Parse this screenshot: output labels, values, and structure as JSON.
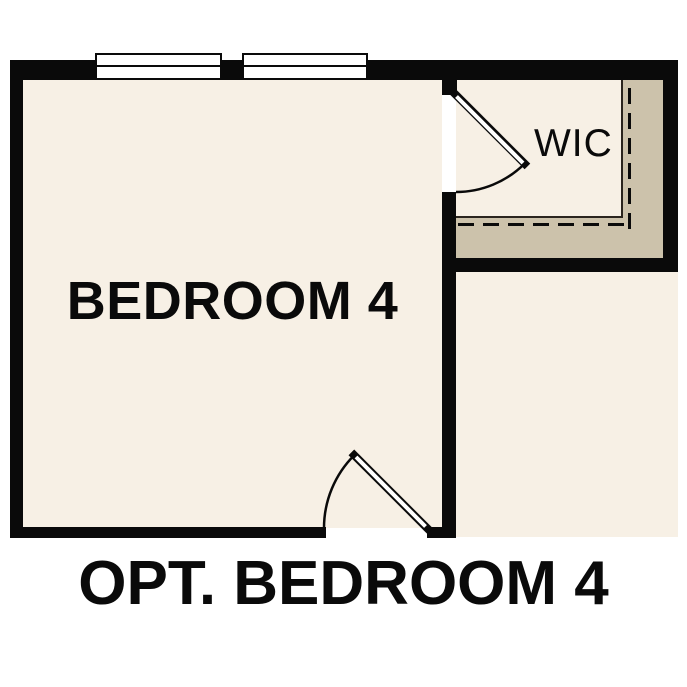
{
  "plan": {
    "caption": "OPT. BEDROOM 4",
    "rooms": [
      {
        "name": "Bedroom 4",
        "label": "BEDROOM 4"
      },
      {
        "name": "Walk-in Closet",
        "label": "WIC"
      }
    ],
    "features": {
      "windows": 2,
      "doors": [
        "bedroom-entry-door",
        "wic-door"
      ],
      "closet_shelf": "L-shaped shelf with dashed rod line"
    }
  },
  "colors": {
    "background": "#ffffff",
    "floor": "#f7f0e5",
    "shelf": "#ccc2ab",
    "wall": "#0a0a0a",
    "window": "#ffffff",
    "text": "#0a0a0a"
  }
}
